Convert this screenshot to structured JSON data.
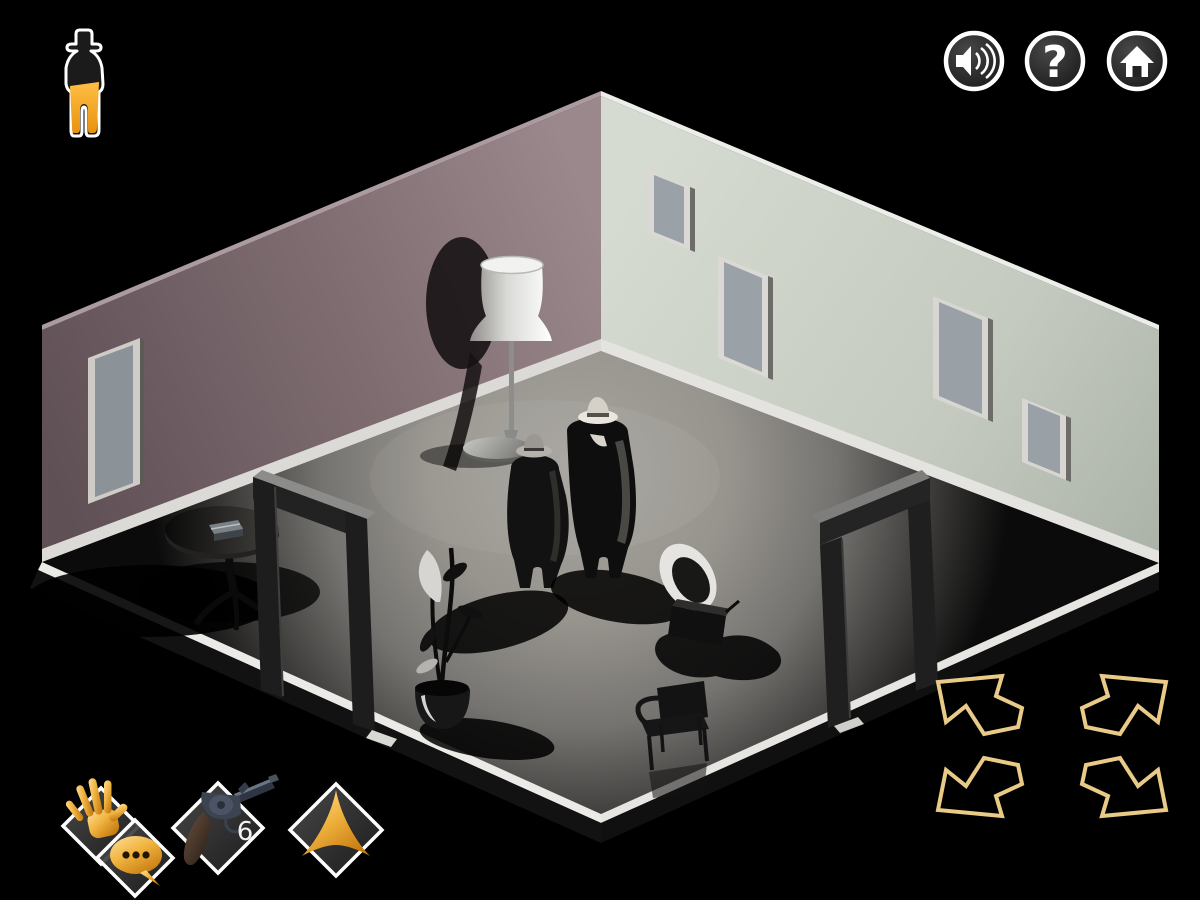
{
  "game": {
    "hud": {
      "character_badge": {
        "icon": "detective-figure-icon",
        "coat_color": "#1b1b1b",
        "pants_color": "#f0a125",
        "outline_color": "#ffffff"
      },
      "system_buttons": [
        {
          "id": "sound",
          "icon": "speaker-icon"
        },
        {
          "id": "help",
          "icon": "question-mark-icon",
          "glyph": "?"
        },
        {
          "id": "home",
          "icon": "home-icon"
        }
      ],
      "action_buttons": [
        {
          "id": "interact",
          "icon": "hand-icon"
        },
        {
          "id": "talk",
          "icon": "speech-bubble-icon"
        },
        {
          "id": "shoot",
          "icon": "revolver-icon",
          "ammo": "6"
        },
        {
          "id": "move",
          "icon": "arrowhead-icon"
        }
      ],
      "nav_arrows": [
        {
          "id": "up-left",
          "icon": "arrow-up-left-icon"
        },
        {
          "id": "up-right",
          "icon": "arrow-up-right-icon"
        },
        {
          "id": "down-left",
          "icon": "arrow-down-left-icon"
        },
        {
          "id": "down-right",
          "icon": "arrow-down-right-icon"
        }
      ],
      "accent_gold": "#e9cb87",
      "diamond_border": "#ffffff",
      "button_ring": "#ffffff"
    },
    "scene": {
      "description": "isometric noir room with two trench-coat detectives",
      "left_wall_color": "#7d6b6f",
      "right_wall_color": "#c6ccc1",
      "floor_color": "#98958f",
      "baseboard_color": "#e8e6e2",
      "objects": [
        {
          "name": "floor-lamp"
        },
        {
          "name": "detective-gray-hat"
        },
        {
          "name": "detective-white-hat"
        },
        {
          "name": "gramophone"
        },
        {
          "name": "potted-plant"
        },
        {
          "name": "chair"
        },
        {
          "name": "pedestal-table"
        },
        {
          "name": "book"
        },
        {
          "name": "door-frame-left"
        },
        {
          "name": "door-frame-right"
        },
        {
          "name": "picture-frame-left-wall"
        },
        {
          "name": "picture-frame-right-1"
        },
        {
          "name": "picture-frame-right-2"
        },
        {
          "name": "picture-frame-right-3"
        },
        {
          "name": "picture-frame-right-4"
        }
      ]
    }
  }
}
